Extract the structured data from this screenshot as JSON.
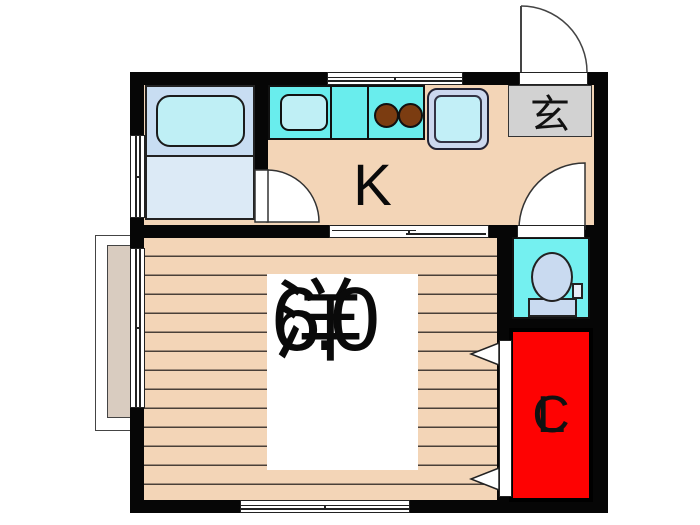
{
  "floorplan": {
    "title": "1K apartment floor plan",
    "labels": {
      "kitchen": "K",
      "entrance": "玄",
      "room_name": "洋",
      "room_size": "6.0",
      "closet_c": "C",
      "closet_l": "L"
    },
    "rooms": [
      {
        "name": "kitchen",
        "label": "K"
      },
      {
        "name": "western-room",
        "label": "洋",
        "size_tatami": "6.0"
      },
      {
        "name": "entrance-genkan",
        "label": "玄"
      },
      {
        "name": "closet",
        "label": "CL"
      },
      {
        "name": "toilet"
      },
      {
        "name": "unit-bath"
      }
    ],
    "colors": {
      "wall": "#060606",
      "floor": "#f3d5b7",
      "floorline": "#4a4038",
      "counter": "#69eded",
      "toilet": "#74f0f0",
      "fixture": "#c9daf0",
      "tub": "#bfeff5",
      "bathtop": "#c8ddf2",
      "bathbottom": "#dceaf6",
      "washrim": "#ccd8ee",
      "washtub": "#c2eff7",
      "genkan": "#d2d2d2",
      "red": "#fe0202",
      "bay": "#d9ccc0",
      "burner": "#7b3c11"
    }
  }
}
